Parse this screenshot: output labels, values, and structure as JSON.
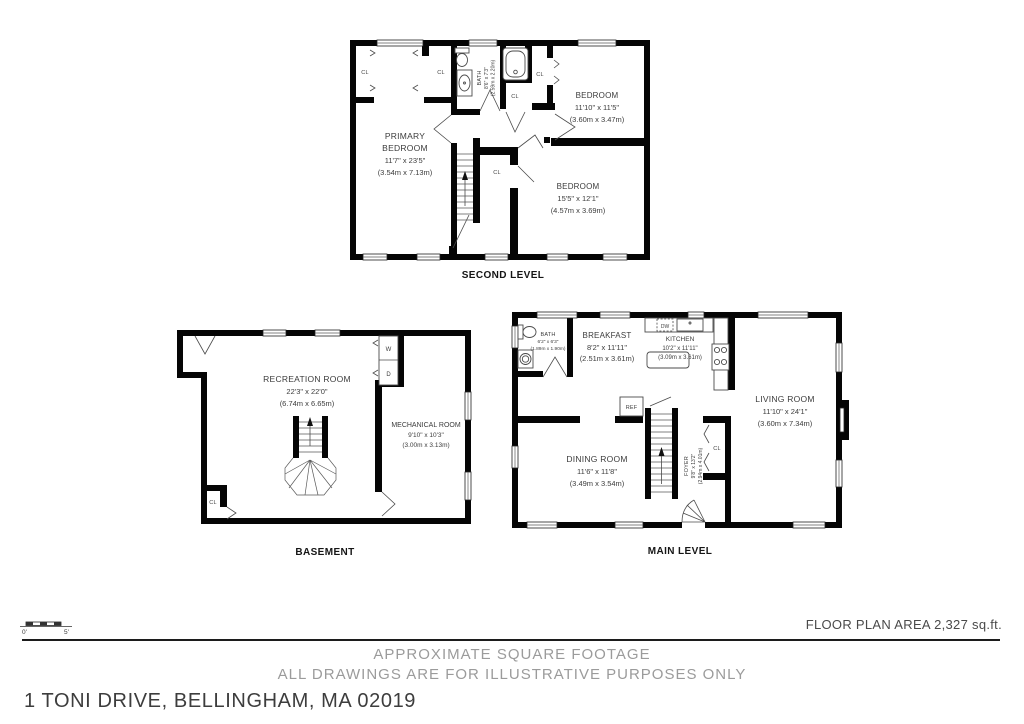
{
  "address": "1 TONI DRIVE, BELLINGHAM, MA 02019",
  "footer": {
    "area": "FLOOR PLAN AREA 2,327 sq.ft.",
    "disclaimer1": "APPROXIMATE SQUARE FOOTAGE",
    "disclaimer2": "ALL DRAWINGS ARE FOR ILLUSTRATIVE PURPOSES ONLY",
    "scale_zero": "0'",
    "scale_five": "5'"
  },
  "second_level": {
    "title": "SECOND LEVEL",
    "primary_bedroom": {
      "line1": "PRIMARY",
      "line2": "BEDROOM",
      "dim_ft": "11'7\" x 23'5\"",
      "dim_m": "(3.54m x 7.13m)"
    },
    "bath": {
      "name": "BATH",
      "dim_ft": "8'6\" x 7'3\"",
      "dim_m": "(2.59m x 2.20m)"
    },
    "bedroom_right": {
      "name": "BEDROOM",
      "dim_ft": "11'10\" x 11'5\"",
      "dim_m": "(3.60m x 3.47m)"
    },
    "bedroom_bottom": {
      "name": "BEDROOM",
      "dim_ft": "15'5\" x 12'1\"",
      "dim_m": "(4.57m x 3.69m)"
    },
    "closet": "CL"
  },
  "basement": {
    "title": "BASEMENT",
    "recreation_room": {
      "name": "RECREATION ROOM",
      "dim_ft": "22'3\" x 22'0\"",
      "dim_m": "(6.74m x 6.65m)"
    },
    "mechanical_room": {
      "name": "MECHANICAL ROOM",
      "dim_ft": "9'10\" x 10'3\"",
      "dim_m": "(3.00m x 3.13m)"
    },
    "washer": "W",
    "dryer": "D",
    "closet": "CL"
  },
  "main_level": {
    "title": "MAIN LEVEL",
    "bath": {
      "name": "BATH",
      "dim_ft": "6'2\" x 6'3\"",
      "dim_m": "(1.89m x 1.90m)"
    },
    "breakfast": {
      "name": "BREAKFAST",
      "dim_ft": "8'2\" x 11'11\"",
      "dim_m": "(2.51m x 3.61m)"
    },
    "kitchen": {
      "name": "KITCHEN",
      "dim_ft": "10'2\" x 11'11\"",
      "dim_m": "(3.09m x 3.61m)"
    },
    "living_room": {
      "name": "LIVING ROOM",
      "dim_ft": "11'10\" x 24'1\"",
      "dim_m": "(3.60m x 7.34m)"
    },
    "dining_room": {
      "name": "DINING ROOM",
      "dim_ft": "11'6\" x 11'8\"",
      "dim_m": "(3.49m x 3.54m)"
    },
    "foyer": {
      "name": "FOYER",
      "dim_ft": "9'8\" x 13'2\"",
      "dim_m": "(2.94m x 4.01m)"
    },
    "dishwasher": "DW",
    "refrigerator": "REF",
    "closet": "CL"
  }
}
